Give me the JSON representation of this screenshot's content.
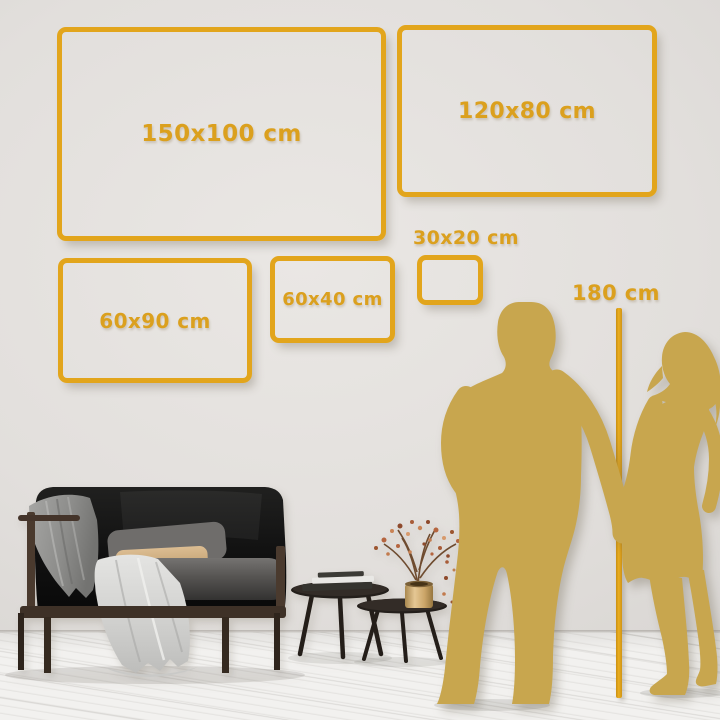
{
  "frames": [
    {
      "id": "150x100",
      "label": "150x100 cm"
    },
    {
      "id": "120x80",
      "label": "120x80 cm"
    },
    {
      "id": "60x90",
      "label": "60x90 cm"
    },
    {
      "id": "60x40",
      "label": "60x40 cm"
    },
    {
      "id": "30x20",
      "label": "30x20 cm"
    }
  ],
  "ruler": {
    "label": "180 cm"
  },
  "palette": {
    "accent_gold": "#E2A51C",
    "text_gold": "#DBA01E",
    "silhouette_gold": "#C8A64E",
    "wall": "#E2DFDC",
    "floor": "#F2F1EF"
  },
  "scene_items": {
    "couple": "man-woman-silhouette-holding-hands",
    "sofa": "black-velvet-sofa",
    "blanket": "gray-throw-blanket",
    "front_drape": "light-gray-cloth-drape",
    "tables": "nesting-coffee-tables",
    "books": "book-stack",
    "vase": "brass-vase-dried-branch"
  }
}
